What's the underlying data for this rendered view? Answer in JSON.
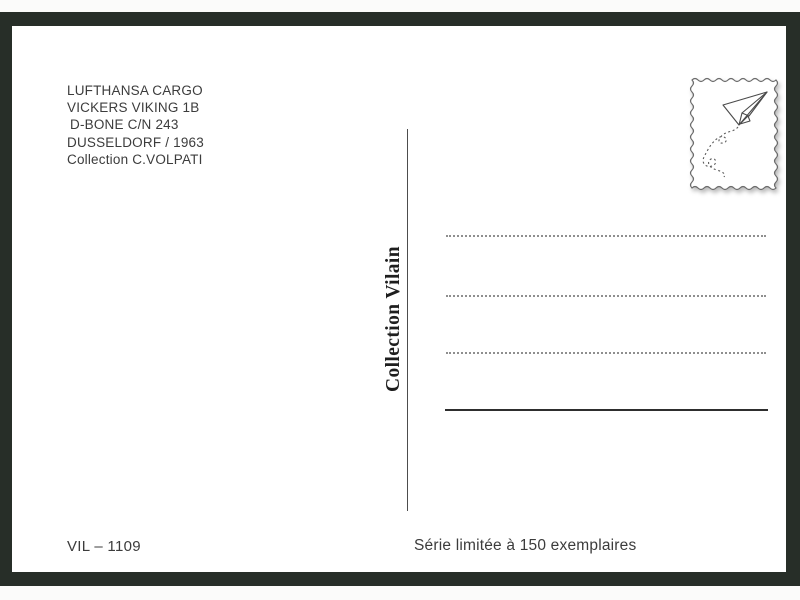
{
  "postcard": {
    "info_block": {
      "lines": [
        "LUFTHANSA CARGO",
        "VICKERS VIKING 1B",
        "D-BONE C/N 243",
        "DUSSELDORF / 1963",
        "Collection C.VOLPATI"
      ]
    },
    "collection_label": "Collection Vilain",
    "reference_number": "VIL – 1109",
    "edition_note": "Série limitée à 150 exemplaires",
    "stamp": {
      "icon": "paper-plane-icon",
      "style": "wavy-edged stamp box with dotted flight trail"
    },
    "colors": {
      "frame": "#272e28",
      "card": "#ffffff",
      "text": "#3c3c3c",
      "divider": "#4d4d4d",
      "stamp_outline": "#6a6a6a"
    }
  }
}
